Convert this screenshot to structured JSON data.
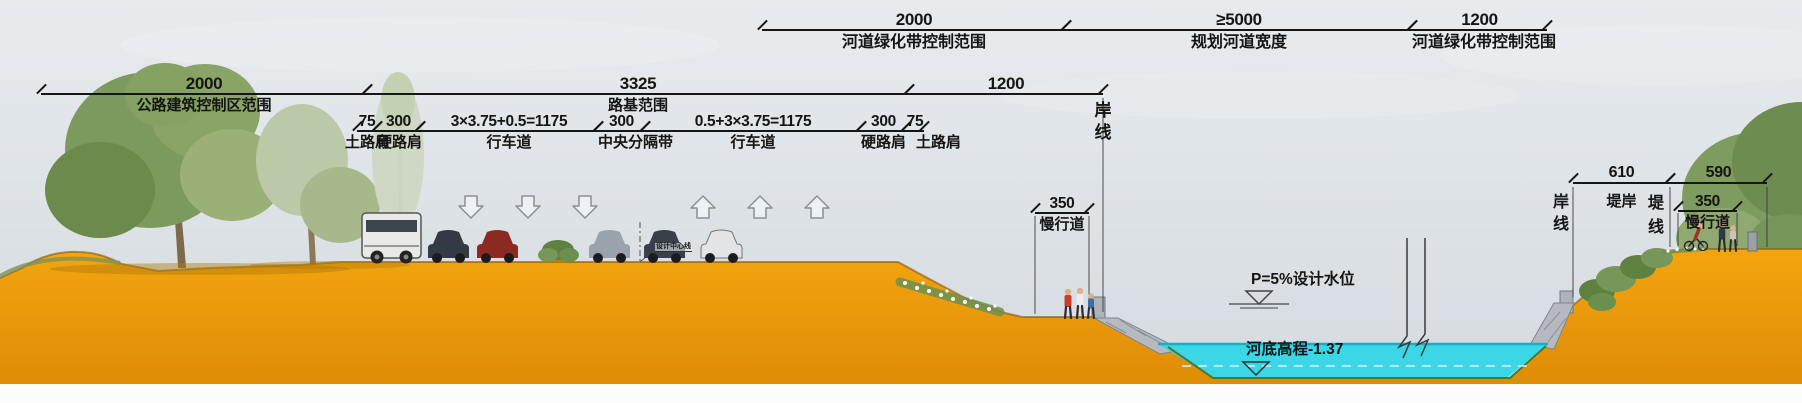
{
  "dims": {
    "green_belt_left": {
      "num": "2000",
      "label": "河道绿化带控制范围"
    },
    "planned_river": {
      "num": "≥5000",
      "label": "规划河道宽度"
    },
    "green_belt_right": {
      "num": "1200",
      "label": "河道绿化带控制范围"
    },
    "road_control": {
      "num": "2000",
      "label": "公路建筑控制区范围"
    },
    "roadbed": {
      "num": "3325",
      "label": "路基范围"
    },
    "bank_1200": {
      "num": "1200"
    },
    "sub1": {
      "num": "75",
      "label": "土路肩"
    },
    "sub2": {
      "num": "300",
      "label": "硬路肩"
    },
    "sub3": {
      "num": "3×3.75+0.5=1175",
      "label": "行车道"
    },
    "sub4": {
      "num": "300",
      "label": "中央分隔带"
    },
    "sub5": {
      "num": "0.5+3×3.75=1175",
      "label": "行车道"
    },
    "sub6": {
      "num": "300",
      "label": "硬路肩"
    },
    "sub7": {
      "num": "75",
      "label": "土路肩"
    },
    "slow_lane_left": {
      "num": "350",
      "label": "慢行道"
    },
    "bank_610": {
      "num": "610",
      "label": "堤岸"
    },
    "bank_590": {
      "num": "590"
    },
    "slow_lane_right": {
      "num": "350",
      "label": "慢行道"
    }
  },
  "texts": {
    "shore_line_left": "岸线",
    "shore_line_right": "岸线",
    "dike_line": "堤线",
    "center_line": "设计中心线",
    "design_water_level": "P=5%设计水位",
    "river_bottom_elevation": "河底高程-1.37"
  },
  "colors": {
    "earth": "#ED9B0B",
    "water": "#3BD7E6",
    "sky": "#DFE3E8",
    "dim_line": "#161616",
    "stone": "#B6BAC0",
    "foliage": "#7C9A5E"
  }
}
